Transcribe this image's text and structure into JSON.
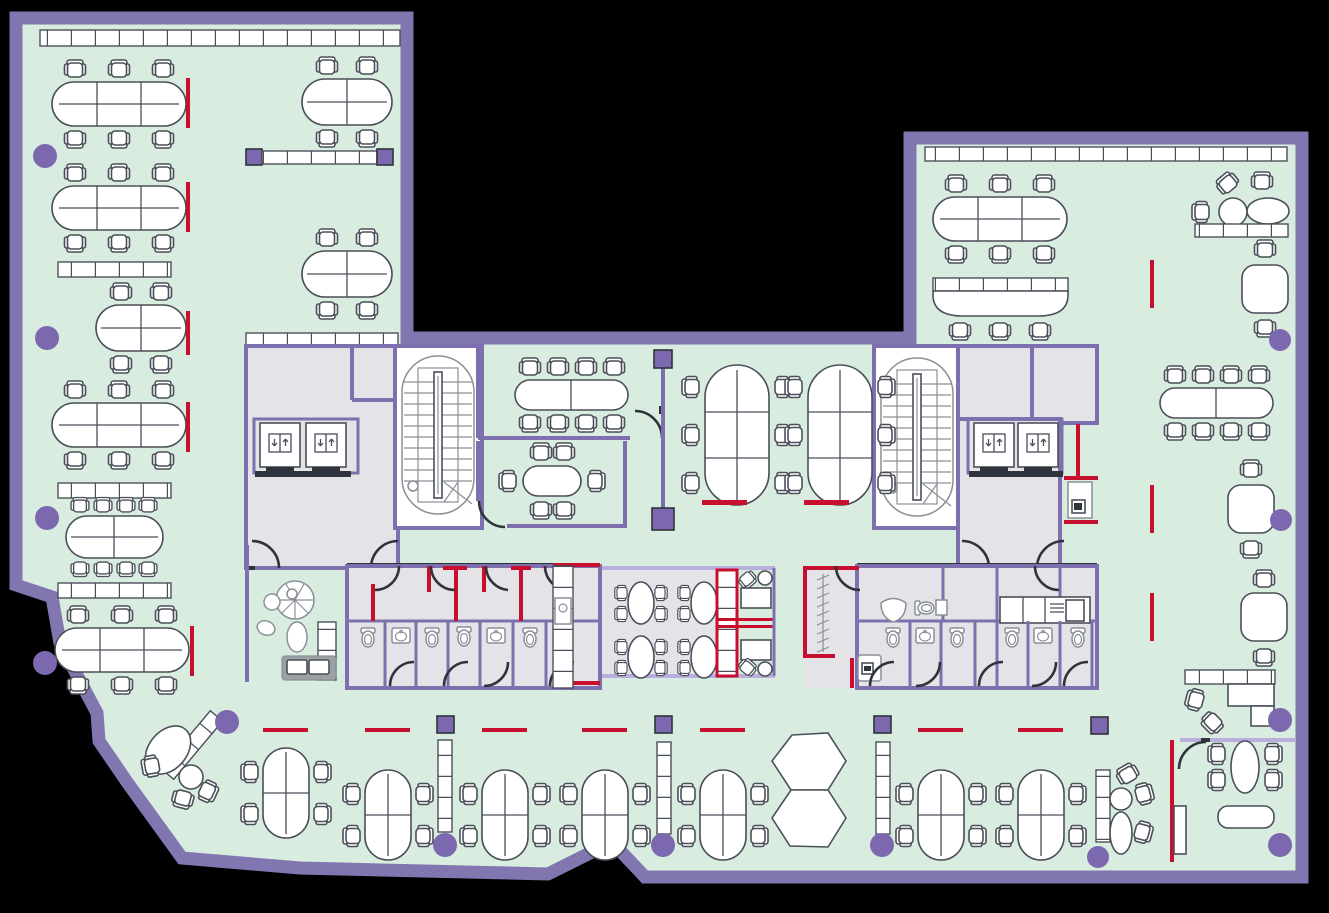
{
  "document": {
    "kind": "office-floor-plan-drawing",
    "canvas": {
      "width": 1329,
      "height": 913
    }
  },
  "colors": {
    "background": "#000000",
    "floor": "#d8ece0",
    "wall": "#8276b1",
    "wall_light": "#b9aedd",
    "partition": "#7e6fae",
    "column": "#7b68ae",
    "accent_red": "#c8102e",
    "furniture_outline": "#4b4f59",
    "furniture_fill": "#ffffff",
    "core_floor": "#e4e4e8",
    "door": "#2f343c",
    "fixture_outline": "#8a9096",
    "sofa": "#9aa0a3"
  },
  "zones": [
    "open-office-left-wing",
    "open-office-top-right-wing",
    "elevator-lobby-left",
    "stairwell-left",
    "meeting-room-large",
    "meeting-room-small",
    "team-desks-center",
    "stairwell-right",
    "elevator-lobby-right",
    "restrooms-left-block",
    "canteen",
    "booth-seating",
    "coat-rack-room",
    "restrooms-right-block",
    "lounge",
    "open-office-bottom-band",
    "open-office-right-wing",
    "corner-office"
  ]
}
